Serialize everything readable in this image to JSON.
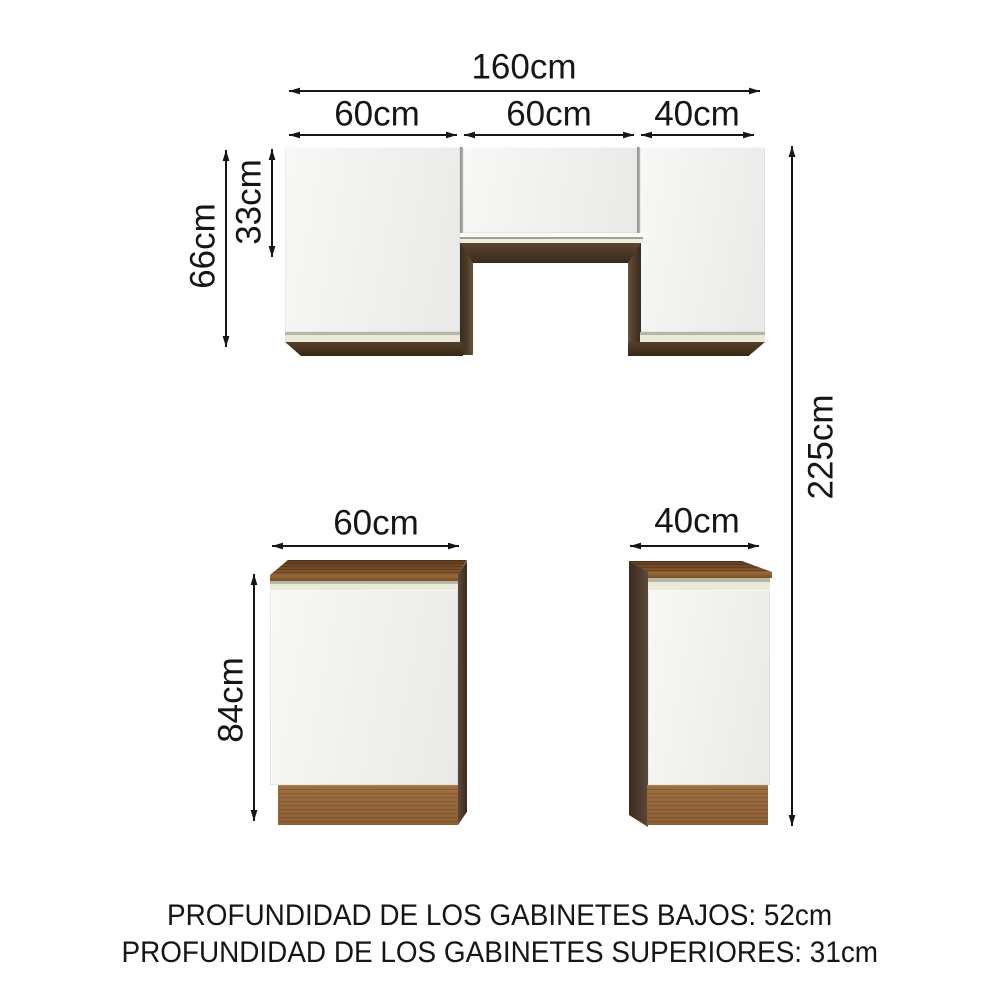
{
  "diagram": {
    "dimensions": {
      "total_width": "160cm",
      "upper_left_width": "60cm",
      "upper_middle_width": "60cm",
      "upper_right_width": "40cm",
      "upper_cabinet_height": "66cm",
      "upper_middle_height": "33cm",
      "total_height": "225cm",
      "lower_left_width": "60cm",
      "lower_right_width": "40cm",
      "lower_cabinet_height": "84cm"
    },
    "footer": {
      "line1": "PROFUNDIDAD DE LOS GABINETES BAJOS: 52cm",
      "line2": "PROFUNDIDAD DE LOS GABINETES SUPERIORES: 31cm"
    },
    "colors": {
      "arrow": "#161616",
      "door_white": "#f2f2f0",
      "wood_dark": "#4a3626",
      "wood_counter": "#7a4f28",
      "wood_plinth": "#93653a",
      "trim_cream": "#ece9d9",
      "trim_gray": "#b2b9ab"
    }
  }
}
